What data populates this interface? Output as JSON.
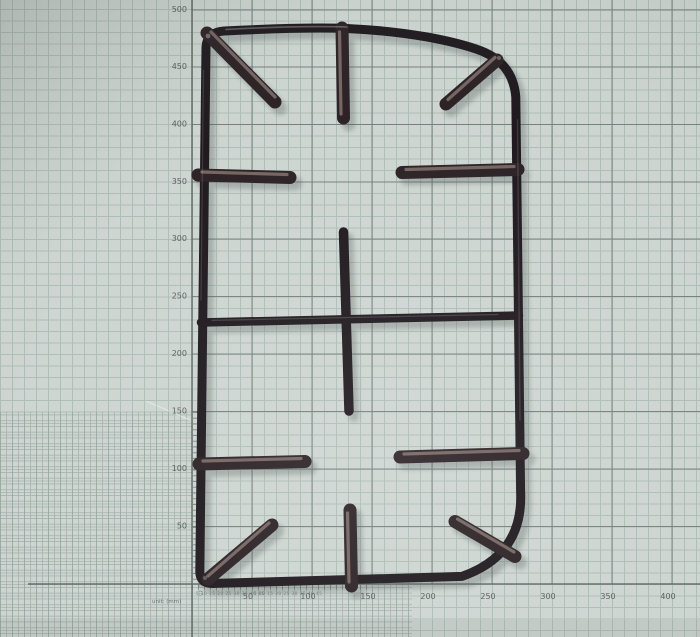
{
  "ruler": {
    "unit_label": "unit: (mm)",
    "vertical_labels": [
      "500",
      "450",
      "400",
      "350",
      "300",
      "250",
      "200",
      "150",
      "100",
      "50"
    ],
    "horizontal_labels": [
      "50",
      "100",
      "150",
      "200",
      "250",
      "300",
      "350",
      "400"
    ],
    "micro_scale_text": "5 10 15 20 25 30 35 40 45"
  },
  "colors": {
    "paper": "#ccd4d0",
    "grid_minor": "#7d948e",
    "grid_major": "#636e6c",
    "axis_line": "#555f5d",
    "label_text": "#3f4644",
    "grate_black": "#191318",
    "prong_base": "#261c20",
    "prong_sheen": "#a39089",
    "shadow": "#4b5552"
  }
}
